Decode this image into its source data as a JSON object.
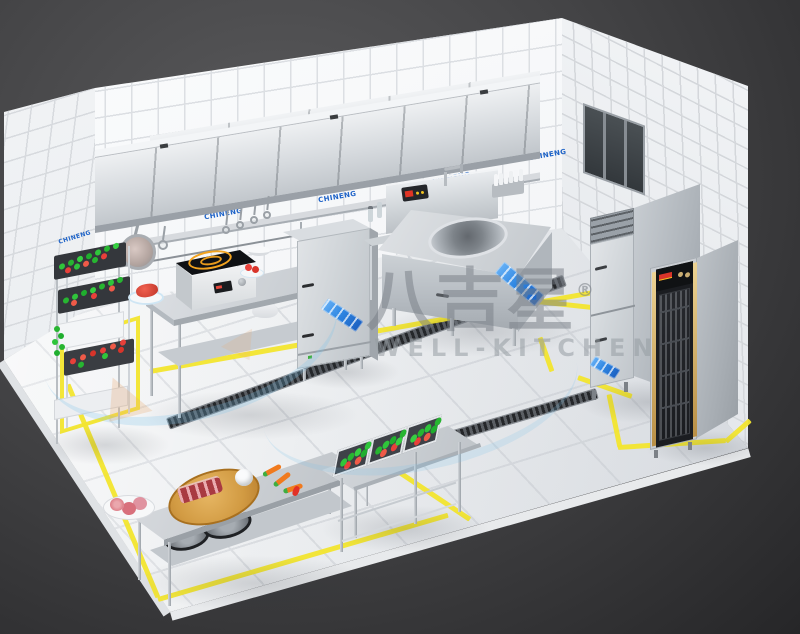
{
  "watermark": {
    "brand_cn": "八吉星",
    "registered": "®",
    "brand_en": "WELL-KITCHEN"
  },
  "brand": {
    "wall_logo": "CHINENG"
  },
  "palette": {
    "background": "#39393b",
    "wall_tile": "#f5f6f8",
    "floor_tile": "#eef0f2",
    "stainless": "#c6cbd0",
    "safety_line_yellow": "#f2e52e",
    "brand_blue": "#1e63c8",
    "ribbon_blue": "#2f87e3",
    "veg_green": "#2fc53b",
    "veg_red": "#e8403a",
    "wood_board": "#d79f45",
    "coil_orange": "#f2a31f",
    "gold_trim": "#d9b66a",
    "drain_grate": "#2f3134",
    "watermark_gray": "#8e949b"
  },
  "equipment": [
    "exhaust-hood",
    "wall-shelf",
    "utensil-rail",
    "hanging-frying-pan",
    "hanging-ladles",
    "vegetable-rack",
    "prep-table",
    "induction-cooker",
    "steam-cabinet",
    "wok-station",
    "condiment-bottle-caddy",
    "upright-fridge",
    "disinfection-cabinet",
    "service-window",
    "cutting-prep-table",
    "triple-wash-sink",
    "trench-drain",
    "safety-floor-markings"
  ]
}
